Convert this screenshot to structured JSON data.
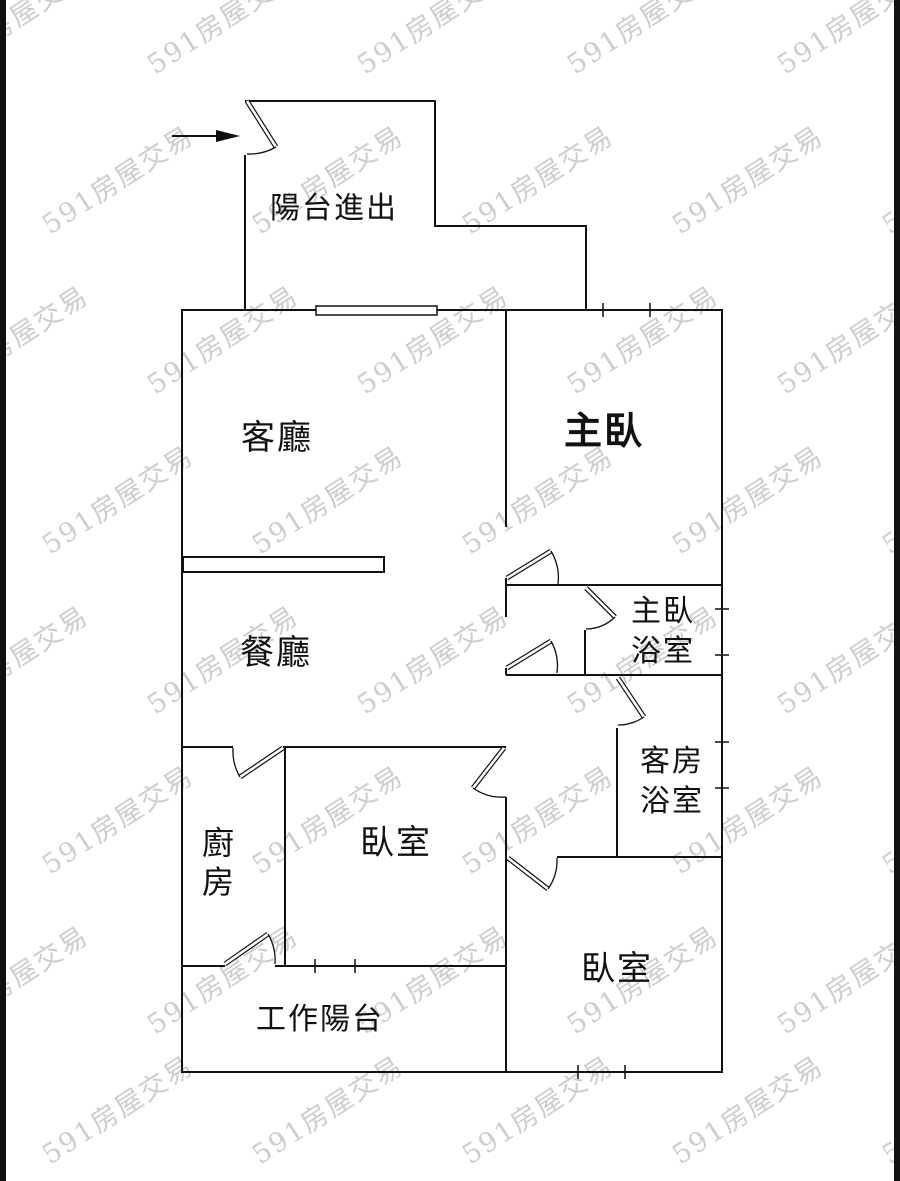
{
  "plan": {
    "rooms": {
      "balcony_entry": {
        "label": "陽台進出"
      },
      "living_room": {
        "label": "客廳"
      },
      "master_bedroom": {
        "label": "主臥"
      },
      "dining_room": {
        "label": "餐廳"
      },
      "master_bathroom": {
        "line1": "主臥",
        "line2": "浴室"
      },
      "guest_bathroom": {
        "line1": "客房",
        "line2": "浴室"
      },
      "kitchen": {
        "line1": "廚",
        "line2": "房"
      },
      "bedroom_left": {
        "label": "臥室"
      },
      "bedroom_right": {
        "label": "臥室"
      },
      "work_balcony": {
        "label": "工作陽台"
      }
    },
    "watermark": {
      "text": "591房屋交易",
      "color": "#cdcdcd"
    },
    "colors": {
      "wall": "#111111",
      "background": "#ffffff",
      "border_bar": "#111111"
    }
  }
}
